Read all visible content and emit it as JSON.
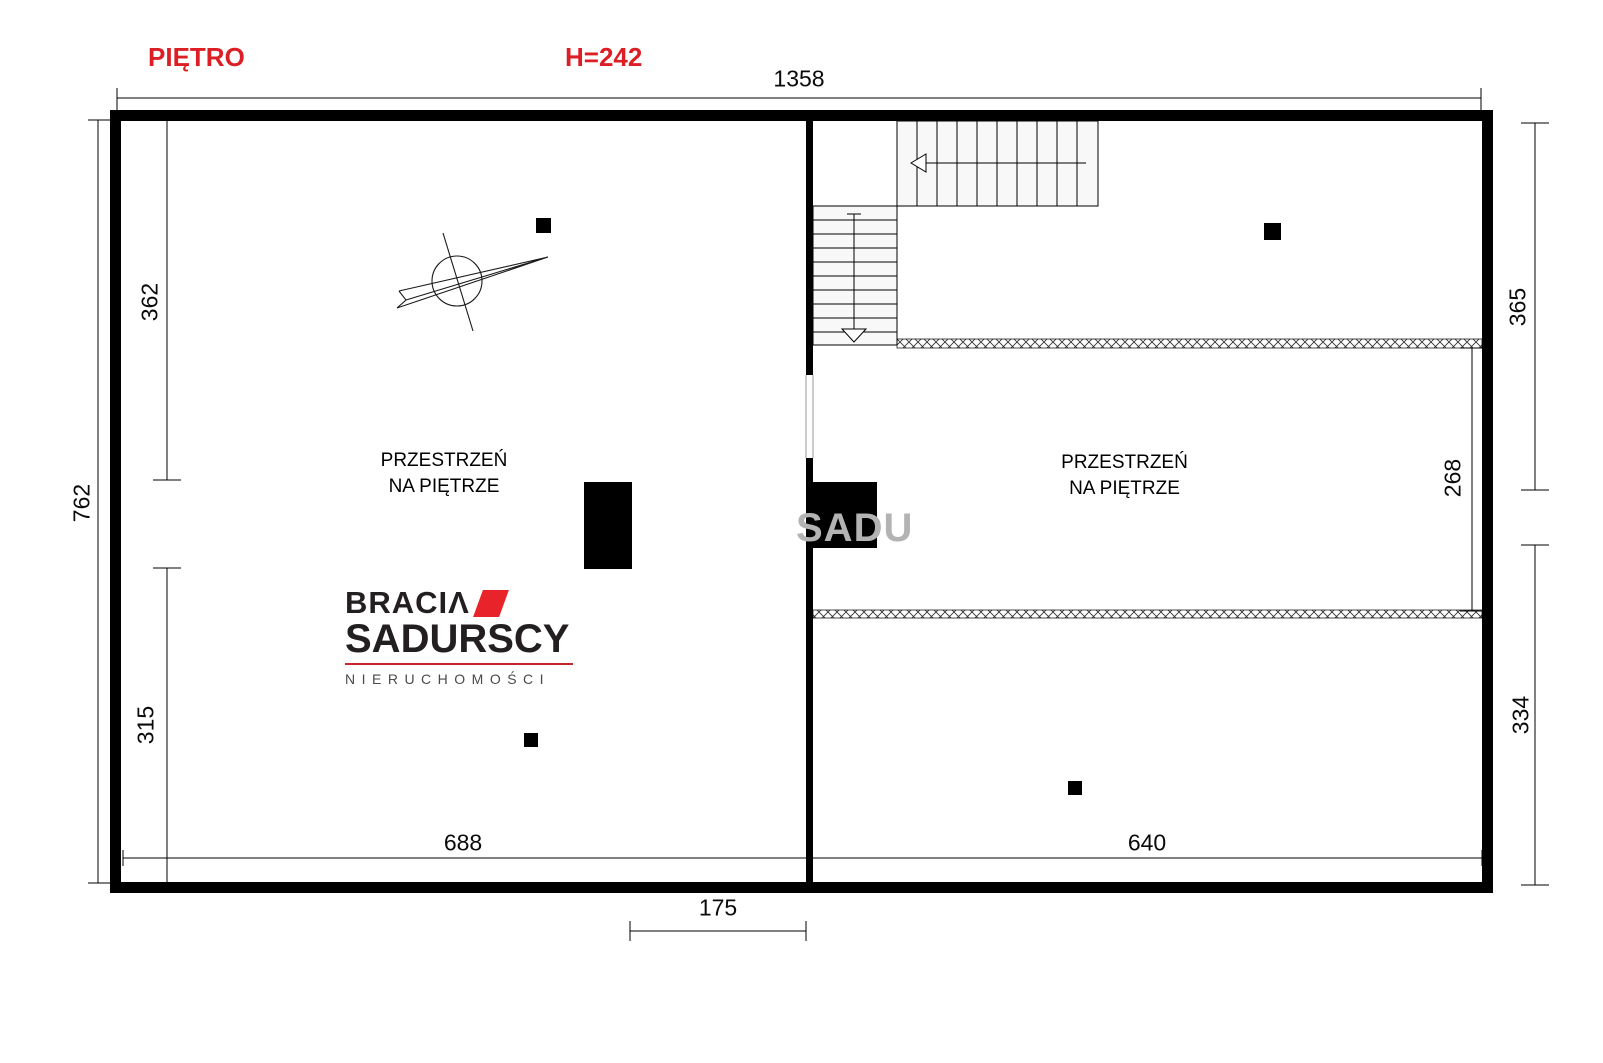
{
  "header": {
    "floor_label": "PIĘTRO",
    "height_label": "H=242"
  },
  "dimensions": {
    "top_width": "1358",
    "left_height": "762",
    "left_upper": "362",
    "left_lower": "315",
    "right_upper": "365",
    "right_inner": "268",
    "right_lower": "334",
    "bottom_left": "688",
    "bottom_right": "640",
    "stair_opening": "175"
  },
  "rooms": {
    "left": {
      "line1": "PRZESTRZEŃ",
      "line2": "NA PIĘTRZE"
    },
    "right": {
      "line1": "PRZESTRZEŃ",
      "line2": "NA PIĘTRZE"
    }
  },
  "logo": {
    "line1": "BRACIΛ",
    "line2": "SADURSCY",
    "tagline": "NIERUCHOMOŚCI"
  },
  "watermark": {
    "text": "SADU"
  },
  "colors": {
    "accent_red": "#dc1e25",
    "logo_red": "#e8232a",
    "wall": "#000000",
    "watermark_gray": "#b3b3b3"
  }
}
